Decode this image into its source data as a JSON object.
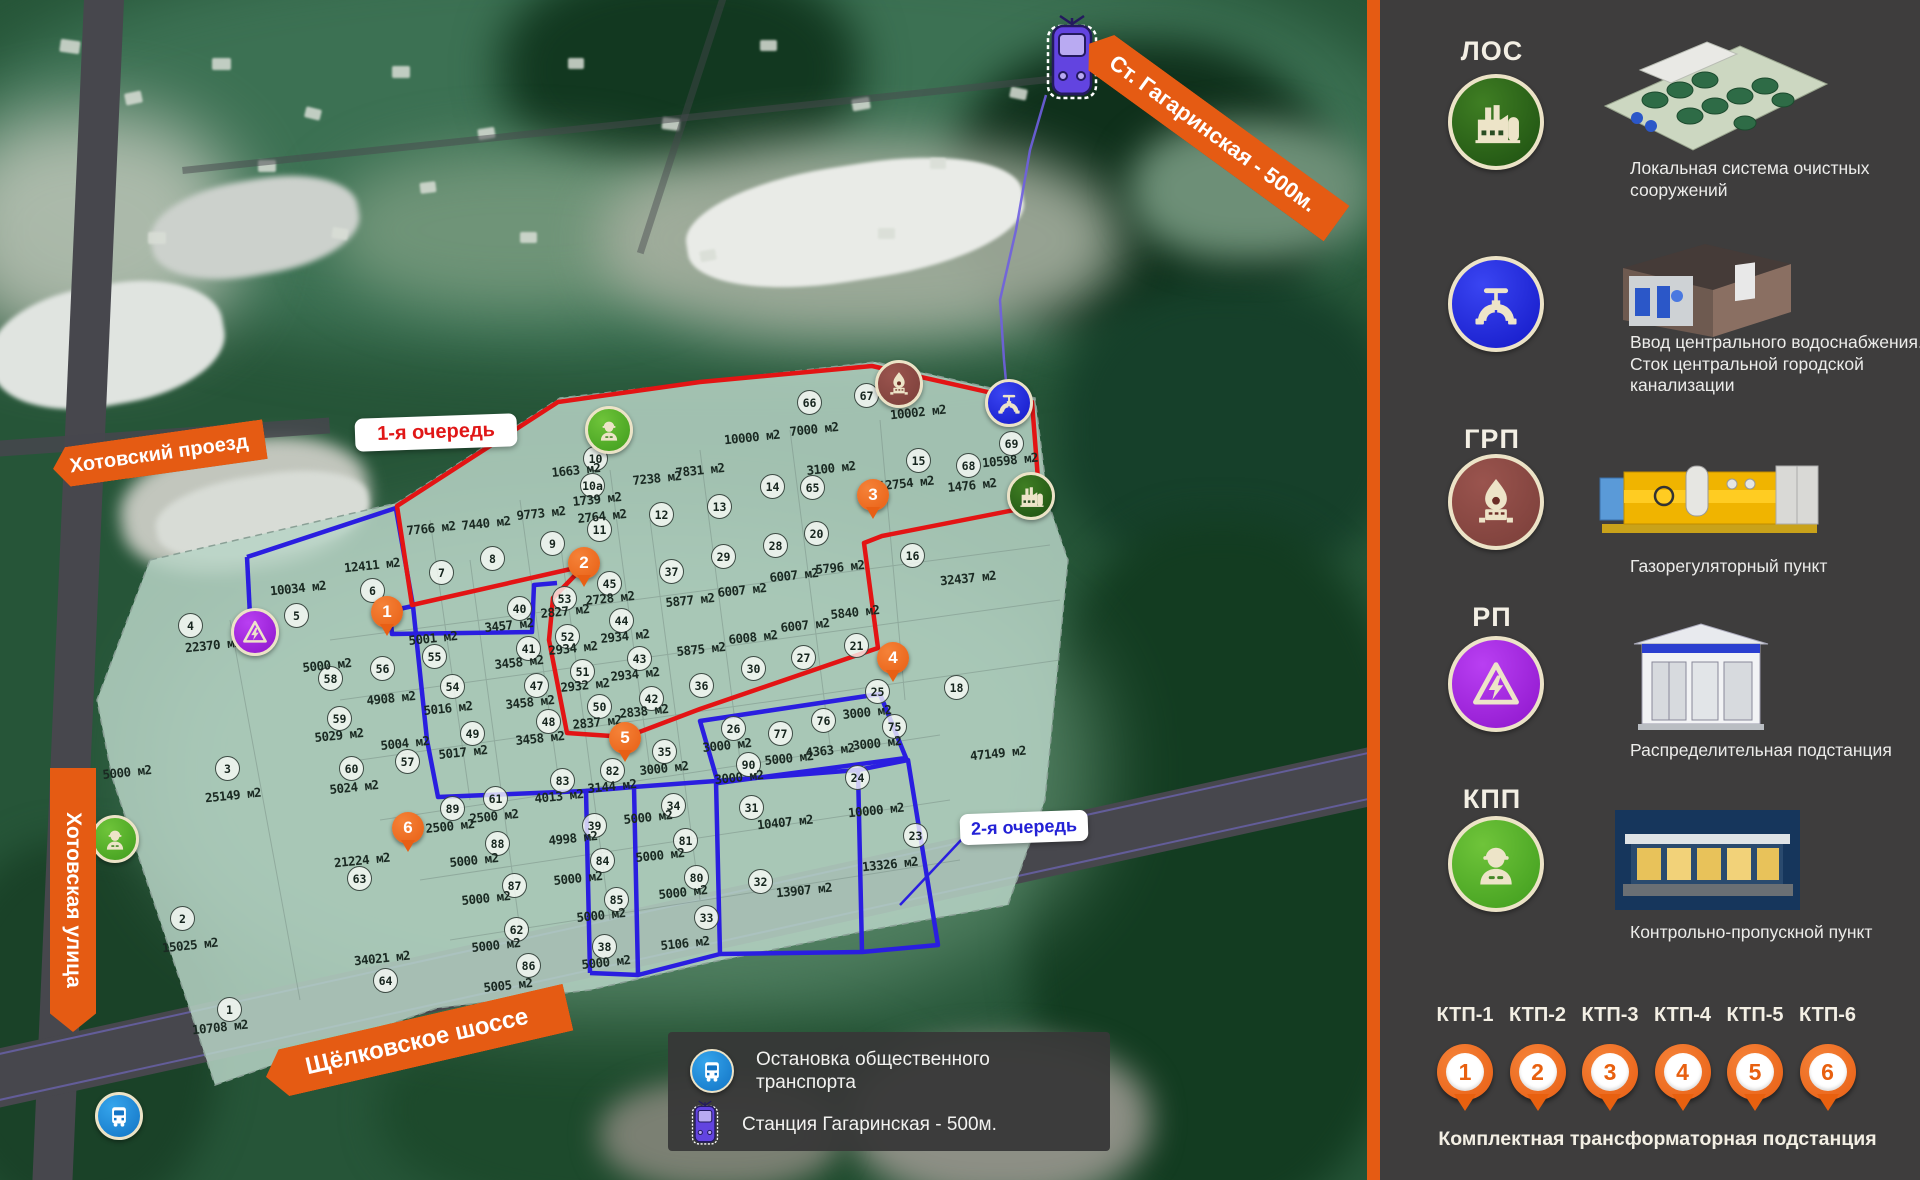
{
  "colors": {
    "accent_orange": "#e55b13",
    "phase1_red": "#e31414",
    "phase2_blue": "#2a1ee0",
    "site_fill": "#b7d3c5",
    "icon_cream": "#ede4c8"
  },
  "map": {
    "phase1_label": "1-я очередь",
    "phase2_label": "2-я очередь",
    "banners": {
      "station": "Ст. Гагаринская - 500м.",
      "road_top": "Хотовский проезд",
      "road_left": "Хотовская улица",
      "road_bottom": "Щёлковское шоссе"
    },
    "transport_legend": [
      {
        "icon": "bus-icon",
        "text": "Остановка общественного транспорта"
      },
      {
        "icon": "tram-icon",
        "text": "Станция  Гагаринская - 500м."
      }
    ],
    "pins": [
      {
        "n": "1",
        "x": 387,
        "y": 612
      },
      {
        "n": "2",
        "x": 584,
        "y": 563
      },
      {
        "n": "3",
        "x": 873,
        "y": 495
      },
      {
        "n": "4",
        "x": 893,
        "y": 658
      },
      {
        "n": "5",
        "x": 625,
        "y": 738
      },
      {
        "n": "6",
        "x": 408,
        "y": 828
      }
    ],
    "site_icons": [
      {
        "type": "kpp",
        "name": "worker-icon",
        "x": 606,
        "y": 427
      },
      {
        "type": "kpp",
        "name": "worker-icon",
        "x": 112,
        "y": 836
      },
      {
        "type": "rp",
        "name": "electric-hazard-icon",
        "x": 252,
        "y": 629
      },
      {
        "type": "grp",
        "name": "gas-flame-icon",
        "x": 896,
        "y": 381
      },
      {
        "type": "water",
        "name": "water-valve-icon",
        "x": 1006,
        "y": 400
      },
      {
        "type": "los",
        "name": "factory-icon",
        "x": 1028,
        "y": 493
      },
      {
        "type": "tram",
        "name": "tram-icon",
        "x": 1072,
        "y": 56
      },
      {
        "type": "bus",
        "name": "bus-icon",
        "x": 116,
        "y": 1113
      }
    ],
    "plots": [
      {
        "n": "10",
        "a": "1663 м2",
        "x": 595,
        "y": 458,
        "ax": 576,
        "ay": 470
      },
      {
        "n": "10а",
        "a": "1739 м2",
        "x": 592,
        "y": 485,
        "ax": 597,
        "ay": 499
      },
      {
        "n": "11",
        "a": "2764 м2",
        "x": 599,
        "y": 529,
        "ax": 602,
        "ay": 516
      },
      {
        "n": "12",
        "a": "7238 м2",
        "x": 661,
        "y": 514,
        "ax": 657,
        "ay": 478
      },
      {
        "n": "13",
        "a": "7831 м2",
        "x": 719,
        "y": 506,
        "ax": 700,
        "ay": 470
      },
      {
        "n": "14",
        "a": "10000 м2",
        "x": 772,
        "y": 486,
        "ax": 752,
        "ay": 437
      },
      {
        "n": "65",
        "a": "3100 м2",
        "x": 812,
        "y": 487,
        "ax": 831,
        "ay": 468
      },
      {
        "n": "66",
        "a": "7000 м2",
        "x": 809,
        "y": 402,
        "ax": 814,
        "ay": 429
      },
      {
        "n": "67",
        "a": "10002 м2",
        "x": 866,
        "y": 395,
        "ax": 918,
        "ay": 412
      },
      {
        "n": "68",
        "a": "1476 м2",
        "x": 968,
        "y": 465,
        "ax": 972,
        "ay": 485
      },
      {
        "n": "69",
        "a": "10598 м2",
        "x": 1011,
        "y": 443,
        "ax": 1010,
        "ay": 460
      },
      {
        "n": "15",
        "a": "12754 м2",
        "x": 918,
        "y": 460,
        "ax": 906,
        "ay": 483
      },
      {
        "n": "7",
        "a": "7766 м2",
        "x": 441,
        "y": 572,
        "ax": 431,
        "ay": 528
      },
      {
        "n": "8",
        "a": "7440 м2",
        "x": 492,
        "y": 558,
        "ax": 486,
        "ay": 523
      },
      {
        "n": "9",
        "a": "9773 м2",
        "x": 552,
        "y": 543,
        "ax": 541,
        "ay": 513
      },
      {
        "n": "6",
        "a": "12411 м2",
        "x": 372,
        "y": 590,
        "ax": 372,
        "ay": 565
      },
      {
        "n": "5",
        "a": "10034 м2",
        "x": 296,
        "y": 615,
        "ax": 298,
        "ay": 588
      },
      {
        "n": "4",
        "a": "22370 м2",
        "x": 190,
        "y": 625,
        "ax": 213,
        "ay": 645
      },
      {
        "n": "16",
        "a": "32437 м2",
        "x": 912,
        "y": 555,
        "ax": 968,
        "ay": 578
      },
      {
        "n": "18",
        "a": "47149 м2",
        "x": 956,
        "y": 687,
        "ax": 998,
        "ay": 753
      },
      {
        "n": "20",
        "a": "5796 м2",
        "x": 816,
        "y": 533,
        "ax": 840,
        "ay": 567
      },
      {
        "n": "28",
        "a": "6007 м2",
        "x": 775,
        "y": 545,
        "ax": 794,
        "ay": 575
      },
      {
        "n": "29",
        "a": "6007 м2",
        "x": 723,
        "y": 556,
        "ax": 742,
        "ay": 590
      },
      {
        "n": "37",
        "a": "5877 м2",
        "x": 671,
        "y": 571,
        "ax": 690,
        "ay": 600
      },
      {
        "n": "21",
        "a": "5840 м2",
        "x": 856,
        "y": 645,
        "ax": 855,
        "ay": 612
      },
      {
        "n": "27",
        "a": "6007 м2",
        "x": 803,
        "y": 657,
        "ax": 805,
        "ay": 625
      },
      {
        "n": "30",
        "a": "6008 м2",
        "x": 753,
        "y": 668,
        "ax": 753,
        "ay": 637
      },
      {
        "n": "36",
        "a": "5875 м2",
        "x": 701,
        "y": 685,
        "ax": 701,
        "ay": 649
      },
      {
        "n": "26",
        "a": "3000 м2",
        "x": 733,
        "y": 728,
        "ax": 727,
        "ay": 745
      },
      {
        "n": "77",
        "a": "5000 м2",
        "x": 780,
        "y": 733,
        "ax": 789,
        "ay": 758
      },
      {
        "n": "76",
        "a": "4363 м2",
        "x": 823,
        "y": 720,
        "ax": 830,
        "ay": 750
      },
      {
        "n": "90",
        "a": "3000 м2",
        "x": 748,
        "y": 764,
        "ax": 739,
        "ay": 777
      },
      {
        "n": "25",
        "a": "3000 м2",
        "x": 877,
        "y": 691,
        "ax": 867,
        "ay": 712
      },
      {
        "n": "75",
        "a": "3000 м2",
        "x": 894,
        "y": 726,
        "ax": 877,
        "ay": 743
      },
      {
        "n": "24",
        "a": "10000 м2",
        "x": 857,
        "y": 777,
        "ax": 876,
        "ay": 810
      },
      {
        "n": "23",
        "a": "13326 м2",
        "x": 915,
        "y": 835,
        "ax": 890,
        "ay": 864
      },
      {
        "n": "31",
        "a": "10407 м2",
        "x": 751,
        "y": 807,
        "ax": 785,
        "ay": 822
      },
      {
        "n": "32",
        "a": "13907 м2",
        "x": 760,
        "y": 881,
        "ax": 804,
        "ay": 890
      },
      {
        "n": "34",
        "a": "5000 м2",
        "x": 673,
        "y": 805,
        "ax": 648,
        "ay": 817
      },
      {
        "n": "35",
        "a": "3000 м2",
        "x": 664,
        "y": 751,
        "ax": 664,
        "ay": 768
      },
      {
        "n": "82",
        "a": "3144 м2",
        "x": 612,
        "y": 770,
        "ax": 612,
        "ay": 786
      },
      {
        "n": "83",
        "a": "4013 м2",
        "x": 562,
        "y": 780,
        "ax": 559,
        "ay": 796
      },
      {
        "n": "81",
        "a": "5000 м2",
        "x": 685,
        "y": 840,
        "ax": 660,
        "ay": 855
      },
      {
        "n": "80",
        "a": "5000 м2",
        "x": 696,
        "y": 877,
        "ax": 683,
        "ay": 892
      },
      {
        "n": "33",
        "a": "5106 м2",
        "x": 706,
        "y": 917,
        "ax": 685,
        "ay": 943
      },
      {
        "n": "39",
        "a": "4998 м2",
        "x": 594,
        "y": 825,
        "ax": 573,
        "ay": 838
      },
      {
        "n": "84",
        "a": "5000 м2",
        "x": 602,
        "y": 860,
        "ax": 578,
        "ay": 878
      },
      {
        "n": "85",
        "a": "5000 м2",
        "x": 616,
        "y": 899,
        "ax": 601,
        "ay": 915
      },
      {
        "n": "38",
        "a": "5000 м2",
        "x": 604,
        "y": 946,
        "ax": 606,
        "ay": 962
      },
      {
        "n": "86",
        "a": "5005 м2",
        "x": 528,
        "y": 965,
        "ax": 508,
        "ay": 985
      },
      {
        "n": "62",
        "a": "5000 м2",
        "x": 516,
        "y": 929,
        "ax": 496,
        "ay": 945
      },
      {
        "n": "87",
        "a": "5000 м2",
        "x": 514,
        "y": 885,
        "ax": 486,
        "ay": 898
      },
      {
        "n": "88",
        "a": "5000 м2",
        "x": 497,
        "y": 843,
        "ax": 474,
        "ay": 860
      },
      {
        "n": "61",
        "a": "2500 м2",
        "x": 495,
        "y": 798,
        "ax": 494,
        "ay": 816
      },
      {
        "n": "89",
        "a": "2500 м2",
        "x": 452,
        "y": 808,
        "ax": 450,
        "ay": 826
      },
      {
        "n": "63",
        "a": "21224 м2",
        "x": 359,
        "y": 878,
        "ax": 362,
        "ay": 860
      },
      {
        "n": "64",
        "a": "34021 м2",
        "x": 385,
        "y": 980,
        "ax": 382,
        "ay": 958
      },
      {
        "n": "1",
        "a": "10708 м2",
        "x": 229,
        "y": 1009,
        "ax": 220,
        "ay": 1027
      },
      {
        "n": "2",
        "a": "15025 м2",
        "x": 182,
        "y": 918,
        "ax": 190,
        "ay": 945
      },
      {
        "n": "3",
        "a": "25149 м2",
        "x": 227,
        "y": 768,
        "ax": 233,
        "ay": 795
      },
      {
        "n": "40",
        "a": "3457 м2",
        "x": 519,
        "y": 608,
        "ax": 509,
        "ay": 625
      },
      {
        "n": "41",
        "a": "3458 м2",
        "x": 528,
        "y": 648,
        "ax": 519,
        "ay": 662
      },
      {
        "n": "47",
        "a": "3458 м2",
        "x": 536,
        "y": 685,
        "ax": 530,
        "ay": 702
      },
      {
        "n": "48",
        "a": "3458 м2",
        "x": 548,
        "y": 721,
        "ax": 540,
        "ay": 738
      },
      {
        "n": "45",
        "a": "2728 м2",
        "x": 609,
        "y": 583,
        "ax": 610,
        "ay": 598
      },
      {
        "n": "53",
        "a": "2827 м2",
        "x": 564,
        "y": 598,
        "ax": 565,
        "ay": 611
      },
      {
        "n": "44",
        "a": "2934 м2",
        "x": 621,
        "y": 620,
        "ax": 625,
        "ay": 636
      },
      {
        "n": "52",
        "a": "2934 м2",
        "x": 567,
        "y": 636,
        "ax": 573,
        "ay": 648
      },
      {
        "n": "43",
        "a": "2934 м2",
        "x": 639,
        "y": 658,
        "ax": 635,
        "ay": 674
      },
      {
        "n": "51",
        "a": "2932 м2",
        "x": 582,
        "y": 671,
        "ax": 585,
        "ay": 685
      },
      {
        "n": "42",
        "a": "2838 м2",
        "x": 651,
        "y": 698,
        "ax": 644,
        "ay": 711
      },
      {
        "n": "50",
        "a": "2837 м2",
        "x": 599,
        "y": 706,
        "ax": 597,
        "ay": 722
      },
      {
        "n": "55",
        "a": "5001 м2",
        "x": 434,
        "y": 656,
        "ax": 433,
        "ay": 638
      },
      {
        "n": "54",
        "a": "5016 м2",
        "x": 452,
        "y": 686,
        "ax": 448,
        "ay": 708
      },
      {
        "n": "56",
        "a": "4908 м2",
        "x": 382,
        "y": 668,
        "ax": 391,
        "ay": 698
      },
      {
        "n": "58",
        "a": "5000 м2",
        "x": 330,
        "y": 678,
        "ax": 327,
        "ay": 665
      },
      {
        "n": "59",
        "a": "5029 м2",
        "x": 339,
        "y": 718,
        "ax": 339,
        "ay": 735
      },
      {
        "n": "60",
        "a": "5024 м2",
        "x": 351,
        "y": 768,
        "ax": 354,
        "ay": 787
      },
      {
        "n": "57",
        "a": "5004 м2",
        "x": 407,
        "y": 761,
        "ax": 405,
        "ay": 743
      },
      {
        "n": "49",
        "a": "5017 м2",
        "x": 472,
        "y": 733,
        "ax": 463,
        "ay": 752
      },
      {
        "n": "",
        "a": "5000 м2",
        "x": 0,
        "y": 0,
        "ax": 127,
        "ay": 772
      }
    ]
  },
  "sidebar": {
    "items": [
      {
        "abbr": "ЛОС",
        "icon": "los",
        "icon_name": "factory-icon",
        "desc": "Локальная система очистных сооружений"
      },
      {
        "abbr": "",
        "icon": "water",
        "icon_name": "water-valve-icon",
        "desc": "Ввод центрального водоснабжения. Сток центральной городской канализации"
      },
      {
        "abbr": "ГРП",
        "icon": "grp",
        "icon_name": "gas-flame-icon",
        "desc": "Газорегуляторный пункт"
      },
      {
        "abbr": "РП",
        "icon": "rp",
        "icon_name": "electric-hazard-icon",
        "desc": "Распределительная подстанция"
      },
      {
        "abbr": "КПП",
        "icon": "kpp",
        "icon_name": "worker-icon",
        "desc": "Контрольно-пропускной пункт"
      }
    ],
    "ktp": {
      "labels": [
        "КТП-1",
        "КТП-2",
        "КТП-3",
        "КТП-4",
        "КТП-5",
        "КТП-6"
      ],
      "numbers": [
        "1",
        "2",
        "3",
        "4",
        "5",
        "6"
      ],
      "caption": "Комплектная трансформаторная подстанция"
    }
  }
}
